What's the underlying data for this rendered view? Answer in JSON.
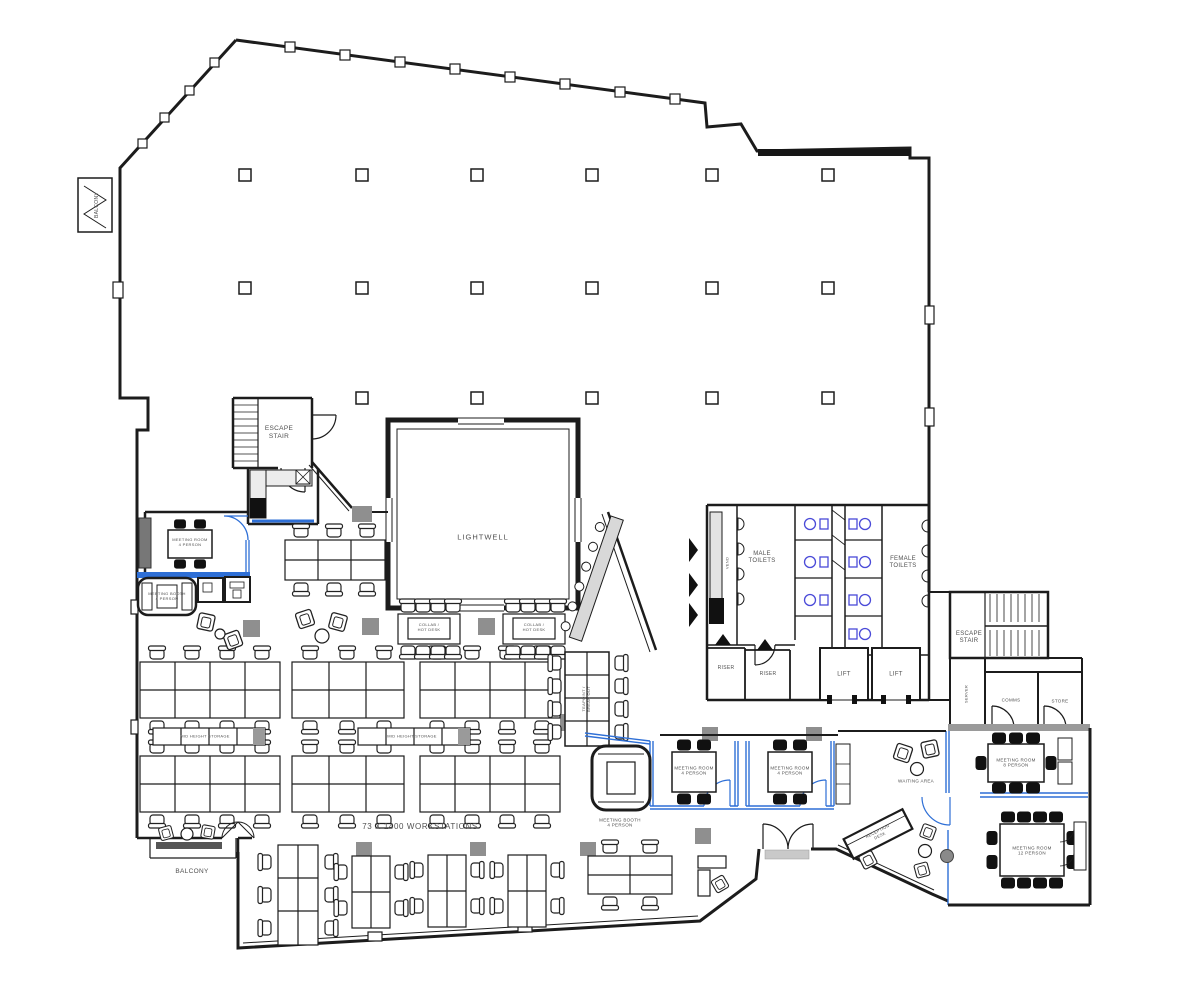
{
  "document": {
    "kind": "office-floor-plan"
  },
  "colors": {
    "wall": "#1c1c1c",
    "accent_blue": "#2e6fd6",
    "fixture_blue": "#4a4ad8",
    "column_gray": "#8f8f8f",
    "counter_gray": "#dcdcdc",
    "storage_gray": "#9a9a9a",
    "text": "#4f4f4f"
  },
  "labels": {
    "balcony_top": "BALCONY",
    "escape_stair_left": "ESCAPE\nSTAIR",
    "lightwell": "LIGHTWELL",
    "collab_hot_desk_1": "COLLAB /\nHOT DESK",
    "collab_hot_desk_2": "COLLAB /\nHOT DESK",
    "vend": "VEND",
    "male_toilets": "MALE\nTOILETS",
    "female_toilets": "FEMALE\nTOILETS",
    "riser_1": "RISER",
    "riser_2": "RISER",
    "lift_1": "LIFT",
    "lift_2": "LIFT",
    "escape_stair_right": "ESCAPE\nSTAIR",
    "server": "SERVER",
    "comms": "COMMS",
    "store": "STORE",
    "meeting_room_4_left": "MEETING ROOM\n4 PERSON",
    "meeting_booth_4_left": "MEETING BOOTH\n4 PERSON",
    "mid_height_storage_1": "MID HEIGHT STORAGE",
    "mid_height_storage_2": "MID HEIGHT STORAGE",
    "teapoint_breakout": "TEAPOINT /\nBREAK OUT",
    "meeting_booth_4_centre": "MEETING BOOTH\n4 PERSON",
    "meeting_room_4_centre_1": "MEETING ROOM\n4 PERSON",
    "meeting_room_4_centre_2": "MEETING ROOM\n4 PERSON",
    "waiting_area": "WAITING AREA",
    "reception_desk": "RECEPTION\nDESK",
    "meeting_room_8": "MEETING ROOM\n8 PERSON",
    "meeting_room_12": "MEETING ROOM\n12 PERSON",
    "workstations_note": "73 X 1400 WORKSTATIONS",
    "balcony_bottom": "BALCONY"
  }
}
